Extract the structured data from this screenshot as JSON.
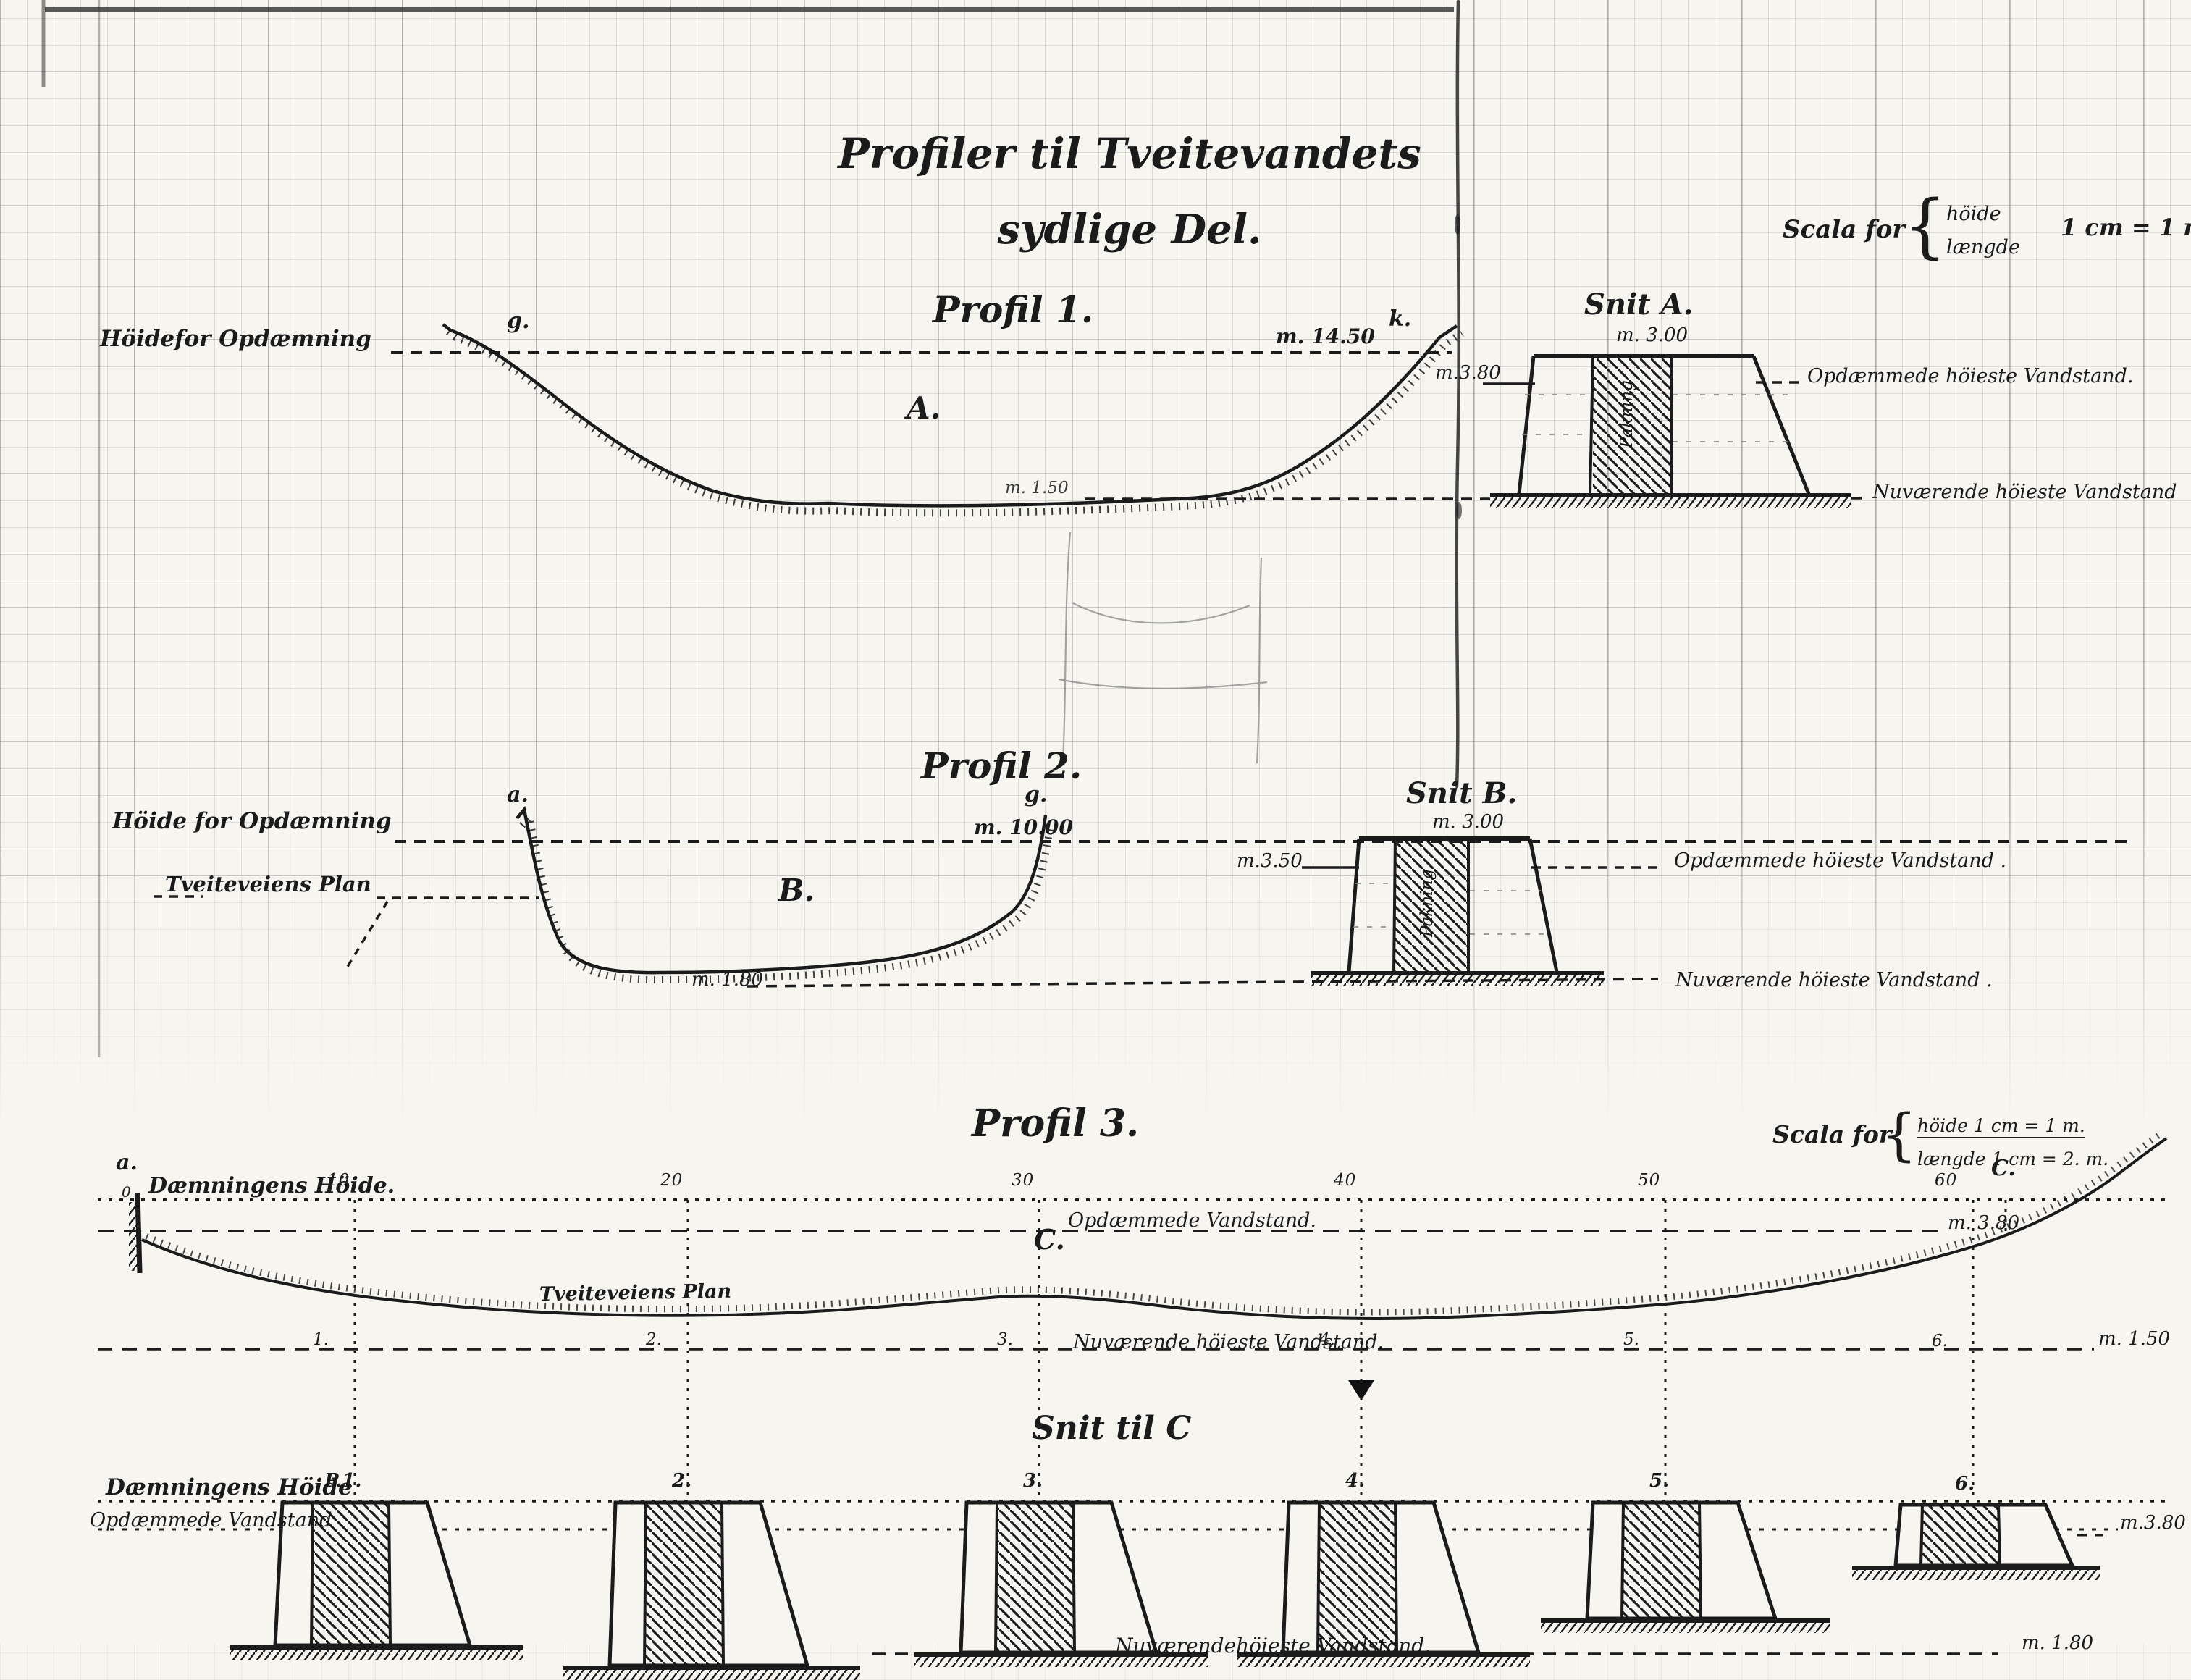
{
  "page": {
    "background": "#f6f5f0",
    "ink": "#1b1b1b"
  },
  "title": {
    "line1": "Profiler til Tveitevandets",
    "line2": "sydlige Del."
  },
  "scale_main": {
    "label": "Scala for",
    "brace": "{",
    "height_word": "höide",
    "length_word": "længde",
    "equation": "1 cm = 1 m."
  },
  "profil1": {
    "title": "Profil 1.",
    "left_label": "Höidefor Opdæmning",
    "point_left": "g.",
    "point_right": "k.",
    "crest_length": "m. 14.50",
    "area_label": "A.",
    "bottom_level": "m. 1.50",
    "dam_water_level": "m.3.80",
    "snit_title": "Snit A.",
    "snit_width": "m. 3.00",
    "core_label": "Pakning",
    "right_upper_label": "Opdæmmede höieste Vandstand.",
    "right_lower_label": "Nuværende höieste Vandstand"
  },
  "profil2": {
    "title": "Profil 2.",
    "left_label": "Höide for Opdæmning",
    "road_label": "Tveiteveiens Plan",
    "point_left": "a.",
    "point_right": "g.",
    "crest_length": "m. 10.00",
    "area_label": "B.",
    "bottom_level": "m. 1.80",
    "dam_water_level": "m.3.50",
    "snit_title": "Snit B.",
    "snit_width": "m. 3.00",
    "core_label": "Pakning",
    "right_upper_label": "Opdæmmede höieste Vandstand .",
    "right_lower_label": "Nuværende höieste Vandstand ."
  },
  "profil3": {
    "title": "Profil 3.",
    "scale_label": "Scala for",
    "scale_height": "höide 1 cm = 1 m.",
    "scale_length": "længde 1 cm = 2. m.",
    "point_left": "a.",
    "zero": "0",
    "point_right": "C.",
    "top_line_label": "Dæmningens Höide.",
    "stations_top": {
      "s1": "10",
      "s2": "20",
      "s3": "30",
      "s4": "40",
      "s5": "50",
      "s6": "60"
    },
    "dam_water_label": "Opdæmmede Vandstand.",
    "dam_water_value": "m. 3.80",
    "area_label": "C.",
    "road_label": "Tveiteveiens Plan",
    "current_water_label": "Nuværende höieste Vandstand.",
    "current_water_value": "m. 1.50",
    "stations_line": {
      "s1": "1.",
      "s2": "2.",
      "s3": "3.",
      "s4": "4.",
      "s5": "5.",
      "s6": "6."
    }
  },
  "snit_c": {
    "title": "Snit til C",
    "top_line_label": "Dæmningens Höide",
    "water_label": "Opdæmmede Vandstand",
    "water_value": "m.3.80",
    "section_labels": {
      "s1": "P.1.",
      "s2": "2.",
      "s3": "3.",
      "s4": "4.",
      "s5": "5.",
      "s6": "6."
    },
    "bottom_label": "Nuværendehöieste Vandstand.",
    "bottom_value": "m. 1.80"
  }
}
